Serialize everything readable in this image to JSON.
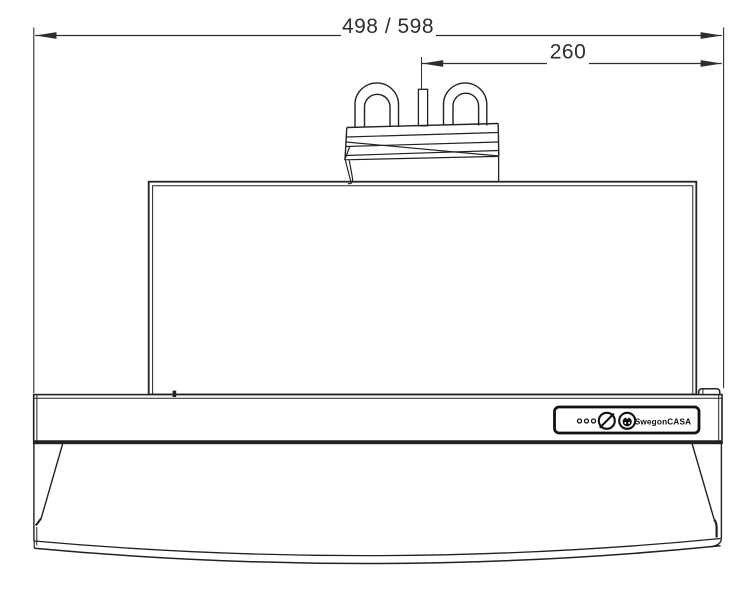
{
  "page": {
    "description": "Technical line drawing: front view of an under-cabinet cooker hood with power cord coiled on top"
  },
  "dimensions": {
    "total_width_label": "498 / 598",
    "right_offset_label": "260"
  },
  "control_panel": {
    "brand_label": "SwegonCASA",
    "led_count": "3",
    "icons": {
      "speed_knob": "slashed-circle-knob-icon",
      "light_knob": "light-knob-icon"
    }
  },
  "colors": {
    "line": "#222222",
    "panel_border": "#111111",
    "background": "#ffffff"
  }
}
